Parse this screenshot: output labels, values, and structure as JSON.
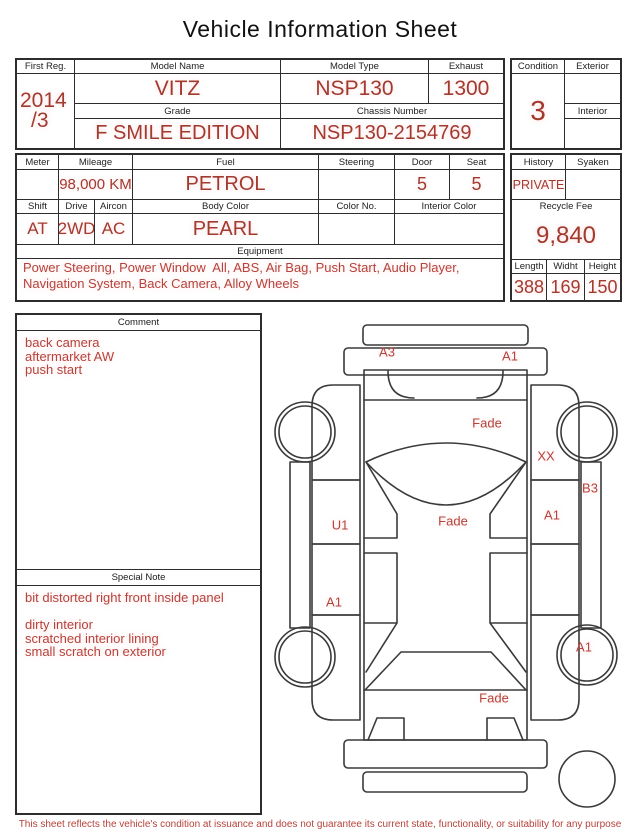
{
  "title": "Vehicle Information Sheet",
  "info_table": {
    "first_reg": {
      "label": "First Reg.",
      "value_line1": "2014",
      "value_line2": "/3"
    },
    "model_name": {
      "label": "Model Name",
      "value": "VITZ"
    },
    "model_type": {
      "label": "Model Type",
      "value": "NSP130"
    },
    "exhaust": {
      "label": "Exhaust",
      "value": "1300"
    },
    "grade": {
      "label": "Grade",
      "value": "F SMILE EDITION"
    },
    "chassis_number": {
      "label": "Chassis Number",
      "value": "NSP130-2154769"
    }
  },
  "condition_box": {
    "condition": {
      "label": "Condition",
      "value": "3"
    },
    "exterior": {
      "label": "Exterior",
      "value": ""
    },
    "interior": {
      "label": "Interior",
      "value": ""
    }
  },
  "spec_table": {
    "meter": {
      "label": "Meter",
      "value": ""
    },
    "mileage": {
      "label": "Mileage",
      "value": "98,000 KM"
    },
    "fuel": {
      "label": "Fuel",
      "value": "PETROL"
    },
    "steering": {
      "label": "Steering",
      "value": ""
    },
    "door": {
      "label": "Door",
      "value": "5"
    },
    "seat": {
      "label": "Seat",
      "value": "5"
    },
    "shift": {
      "label": "Shift",
      "value": "AT"
    },
    "drive": {
      "label": "Drive",
      "value": "2WD"
    },
    "aircon": {
      "label": "Aircon",
      "value": "AC"
    },
    "body_color": {
      "label": "Body Color",
      "value": "PEARL"
    },
    "color_no": {
      "label": "Color No.",
      "value": ""
    },
    "interior_color": {
      "label": "Interior Color",
      "value": ""
    },
    "equipment": {
      "label": "Equipment",
      "value": "Power Steering, Power Window  All, ABS, Air Bag, Push Start, Audio Player, Navigation System, Back Camera, Alloy Wheels"
    }
  },
  "history_box": {
    "history": {
      "label": "History",
      "value": "PRIVATE"
    },
    "syaken": {
      "label": "Syaken",
      "value": ""
    },
    "recycle_fee": {
      "label": "Recycle Fee",
      "value": "9,840"
    },
    "length": {
      "label": "Length",
      "value": "388"
    },
    "width": {
      "label": "Widht",
      "value": "169"
    },
    "height": {
      "label": "Height",
      "value": "150"
    }
  },
  "comment": {
    "label": "Comment",
    "lines": [
      "back camera",
      "aftermarket AW",
      "push start"
    ]
  },
  "special_note": {
    "label": "Special Note",
    "lines": [
      "bit distorted right front inside panel",
      "",
      "dirty interior",
      "scratched interior lining",
      "small scratch on exterior"
    ]
  },
  "diagram": {
    "labels": [
      {
        "text": "A3",
        "x": 127,
        "y": 42
      },
      {
        "text": "A1",
        "x": 250,
        "y": 46
      },
      {
        "text": "Fade",
        "x": 227,
        "y": 113
      },
      {
        "text": "XX",
        "x": 286,
        "y": 146
      },
      {
        "text": "B3",
        "x": 330,
        "y": 178
      },
      {
        "text": "U1",
        "x": 80,
        "y": 215
      },
      {
        "text": "A1",
        "x": 292,
        "y": 205
      },
      {
        "text": "Fade",
        "x": 193,
        "y": 211
      },
      {
        "text": "A1",
        "x": 74,
        "y": 292
      },
      {
        "text": "A1",
        "x": 324,
        "y": 337
      },
      {
        "text": "Fade",
        "x": 234,
        "y": 388
      }
    ]
  },
  "footer": {
    "text": "This sheet reflects the vehicle's condition at issuance and does not guarantee its current state, functionality, or suitability for any purpose"
  },
  "colors": {
    "value_red": "#a23a2e",
    "note_red": "#b6423a",
    "border": "#2d2d2d"
  }
}
